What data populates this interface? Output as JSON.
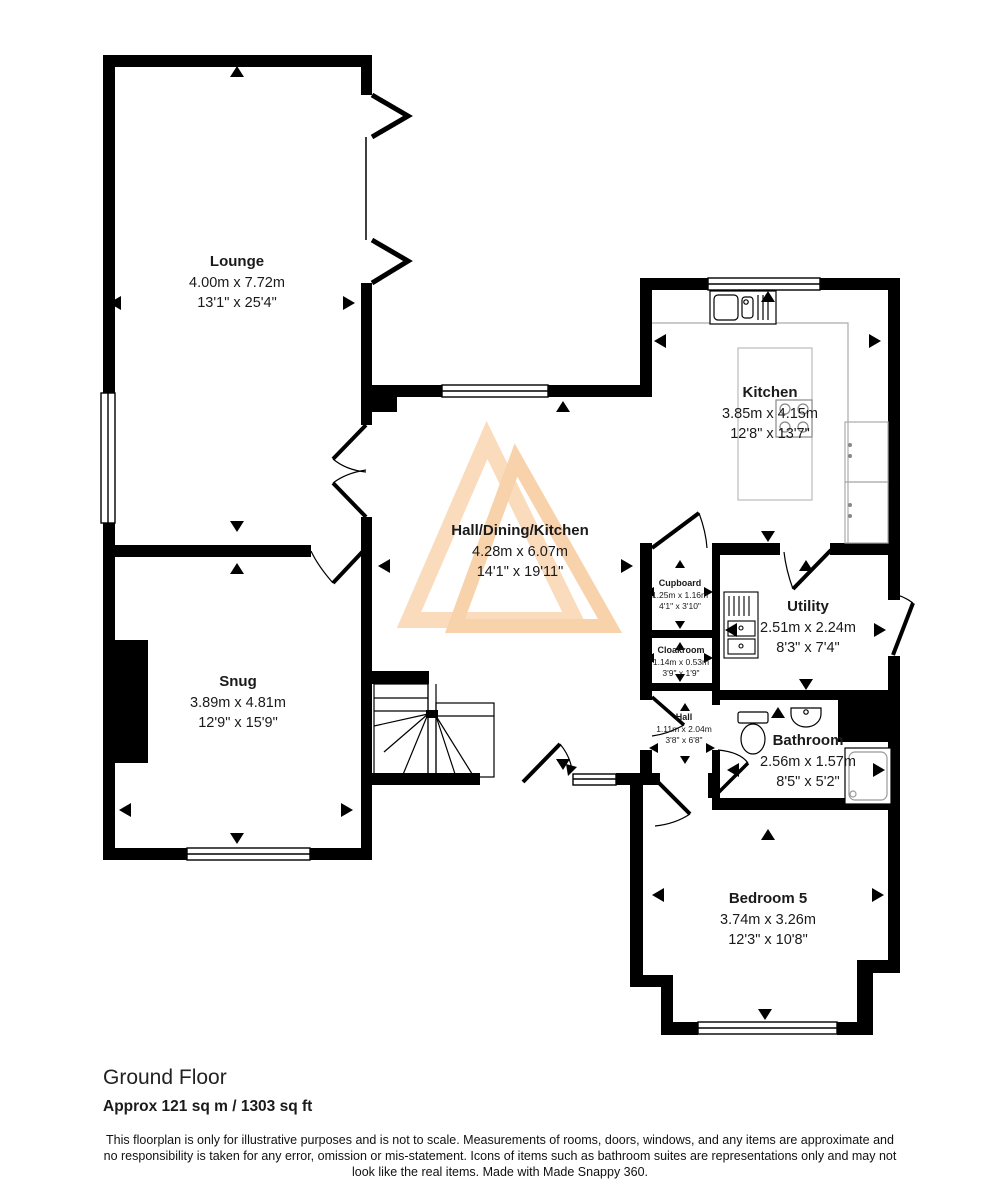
{
  "floorplan": {
    "rooms": [
      {
        "name": "Lounge",
        "metric": "4.00m x 7.72m",
        "imperial": "13'1\" x 25'4\""
      },
      {
        "name": "Kitchen",
        "metric": "3.85m x 4.15m",
        "imperial": "12'8\" x 13'7\""
      },
      {
        "name": "Hall/Dining/Kitchen",
        "metric": "4.28m x 6.07m",
        "imperial": "14'1\" x 19'11\""
      },
      {
        "name": "Snug",
        "metric": "3.89m x 4.81m",
        "imperial": "12'9\" x 15'9\""
      },
      {
        "name": "Cupboard",
        "metric": "1.25m x 1.16m",
        "imperial": "4'1\" x 3'10\""
      },
      {
        "name": "Cloakroom",
        "metric": "1.14m x 0.53m",
        "imperial": "3'9\" x 1'9\""
      },
      {
        "name": "Utility",
        "metric": "2.51m x 2.24m",
        "imperial": "8'3\" x 7'4\""
      },
      {
        "name": "Hall",
        "metric": "1.11m x 2.04m",
        "imperial": "3'8\" x 6'8\""
      },
      {
        "name": "Bathroom",
        "metric": "2.56m x 1.57m",
        "imperial": "8'5\" x 5'2\""
      },
      {
        "name": "Bedroom 5",
        "metric": "3.74m x 3.26m",
        "imperial": "12'3\" x 10'8\""
      }
    ],
    "footer": {
      "floor_label": "Ground Floor",
      "area_label": "Approx 121 sq m / 1303 sq ft",
      "disclaimer": "This floorplan is only for illustrative purposes and is not to scale. Measurements of rooms, doors, windows, and any items are approximate and no responsibility is taken for any error, omission or mis-statement. Icons of items such as bathroom suites are representations only and may not look like the real items. Made with Made Snappy 360."
    },
    "watermark_color": "#fadcbd",
    "wall_color": "#000000"
  }
}
